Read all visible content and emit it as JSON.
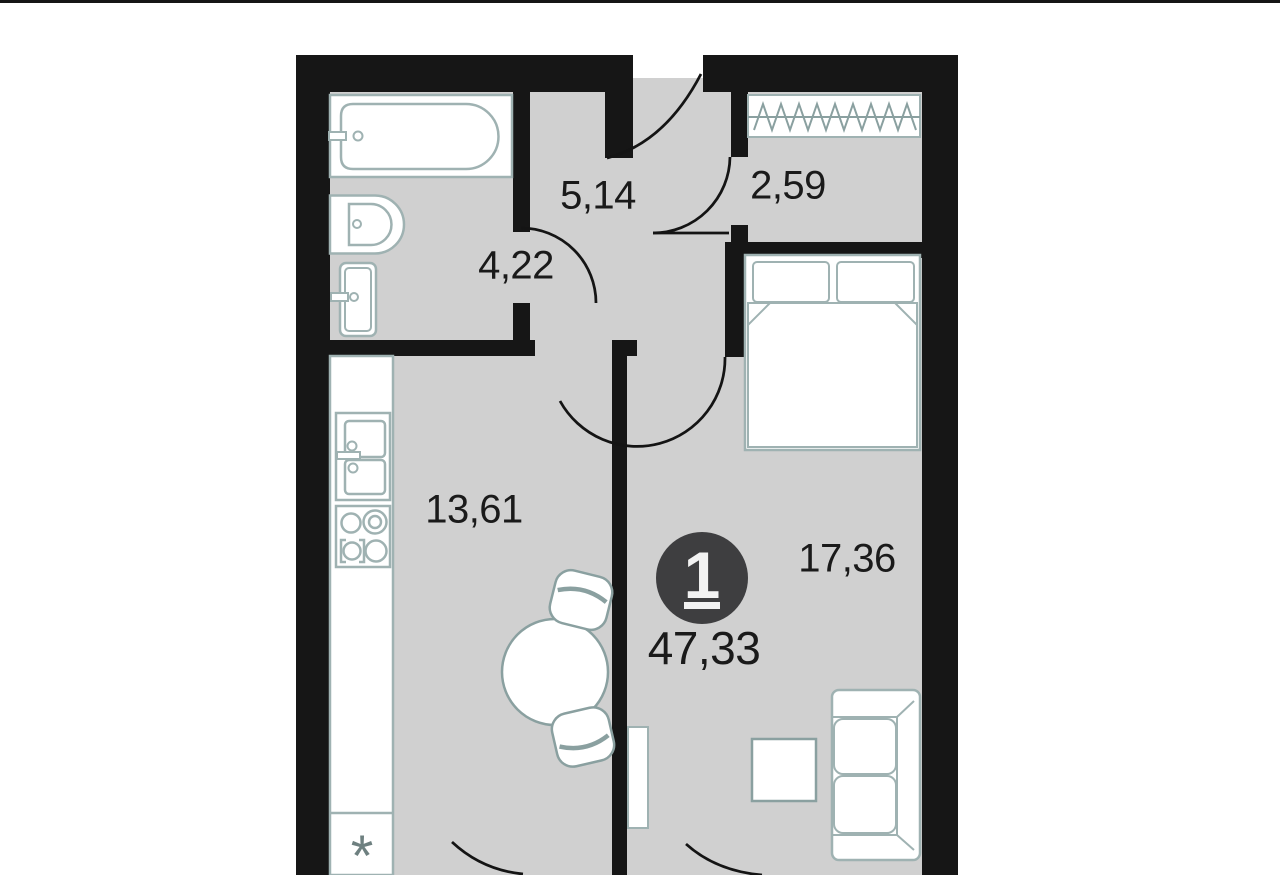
{
  "plan": {
    "title": "one-room apartment floor plan",
    "type_badge": {
      "number": "1",
      "total_area": "47,33"
    },
    "rooms": [
      {
        "name": "hallway",
        "area_m2": "5,14"
      },
      {
        "name": "wardrobe",
        "area_m2": "2,59"
      },
      {
        "name": "bathroom",
        "area_m2": "4,22"
      },
      {
        "name": "kitchen",
        "area_m2": "13,61"
      },
      {
        "name": "living-room",
        "area_m2": "17,36"
      }
    ],
    "annotations": {
      "refrigerator_slot": "*"
    },
    "fixtures": [
      "bathtub",
      "toilet",
      "washbasin",
      "kitchen-counter",
      "kitchen-sink",
      "stove-4-burner",
      "refrigerator-slot",
      "dining-table",
      "chair",
      "chair",
      "wardrobe-rail",
      "double-bed",
      "sofa",
      "coffee-table",
      "radiator"
    ],
    "doors": [
      "entrance-door",
      "wardrobe-door",
      "bathroom-door",
      "living-room-door",
      "kitchen-balcony-door",
      "living-balcony-door"
    ],
    "colors": {
      "wall": "#161616",
      "floor": "#d0d0d0",
      "fixture_outline": "#9fb2b2",
      "furniture_outline": "#8aa0a0",
      "badge_bg": "#3e3e40",
      "badge_text": "#f2f2f2",
      "label_text": "#1a1a1a",
      "asterisk": "#6e8080"
    }
  }
}
